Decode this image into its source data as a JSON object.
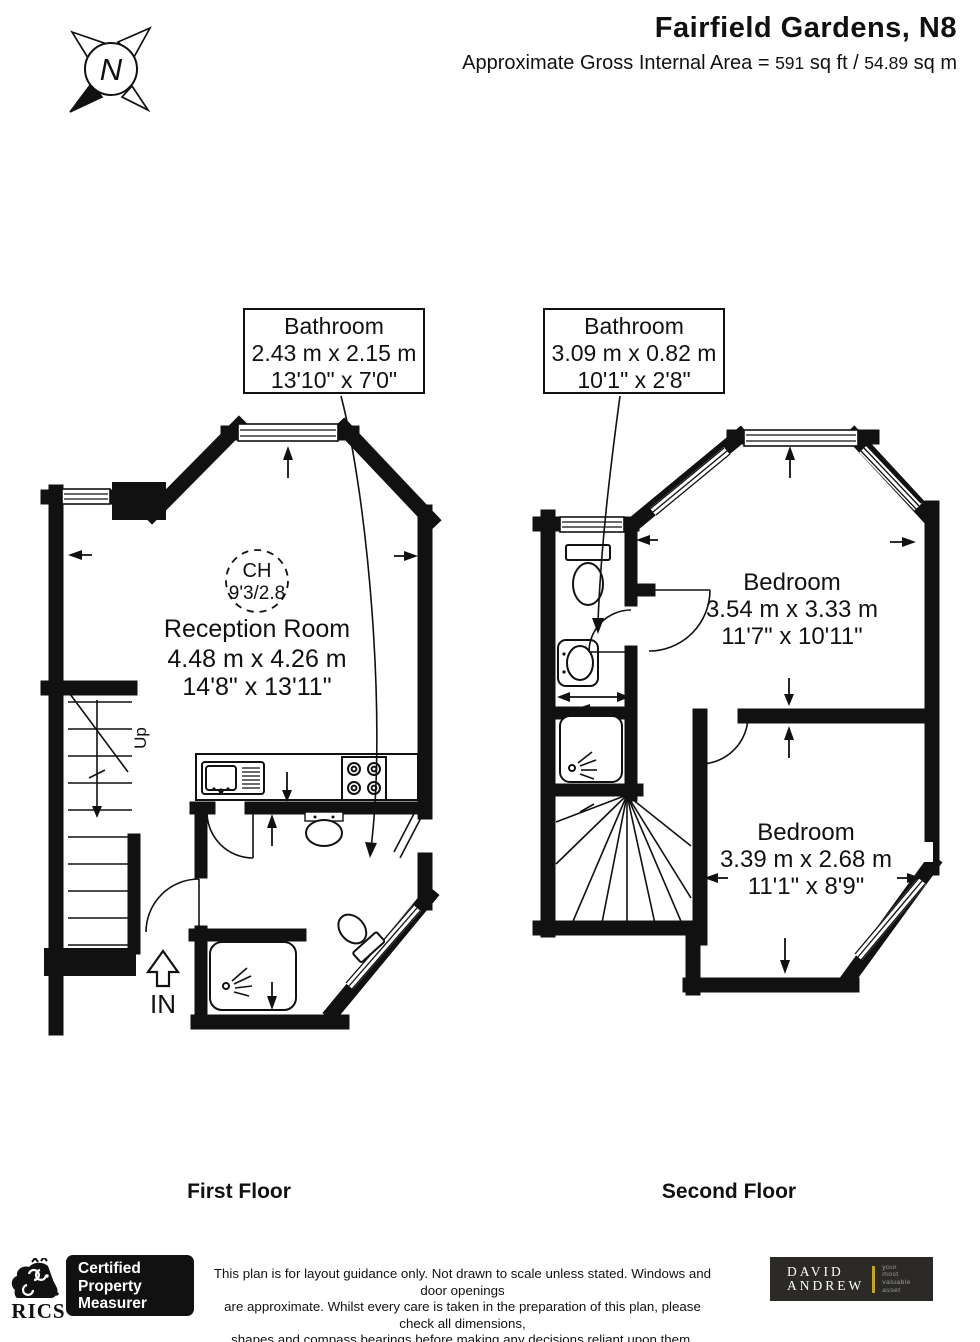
{
  "header": {
    "title": "Fairfield Gardens, N8",
    "area_label": "Approximate Gross Internal Area =",
    "area_sqft": "591",
    "area_sqft_unit": "sq ft /",
    "area_sqm": "54.89",
    "area_sqm_unit": "sq m"
  },
  "compass": {
    "letter": "N"
  },
  "callouts": {
    "ff_bathroom": {
      "name": "Bathroom",
      "metric": "2.43 m x 2.15 m",
      "imperial": "13'10\" x 7'0\""
    },
    "sf_bathroom": {
      "name": "Bathroom",
      "metric": "3.09 m x 0.82 m",
      "imperial": "10'1\" x 2'8\""
    }
  },
  "rooms": {
    "reception": {
      "name": "Reception Room",
      "metric": "4.48 m x 4.26 m",
      "imperial": "14'8\" x 13'11\""
    },
    "bedroom1": {
      "name": "Bedroom",
      "metric": "3.54 m x 3.33 m",
      "imperial": "11'7\" x 10'11\""
    },
    "bedroom2": {
      "name": "Bedroom",
      "metric": "3.39 m x 2.68 m",
      "imperial": "11'1\" x 8'9\""
    }
  },
  "annotations": {
    "ceiling_height": {
      "line1": "CH",
      "line2": "9'3/2.8"
    },
    "up": "Up",
    "entrance": "IN"
  },
  "floor_titles": {
    "first": "First Floor",
    "second": "Second Floor"
  },
  "footer": {
    "rics_name": "RICS",
    "rics_reg": "®",
    "certified_lines": [
      "Certified",
      "Property",
      "Measurer"
    ],
    "disclaimer_lines": [
      "This plan is for layout guidance only. Not drawn to scale unless stated. Windows and door openings",
      "are approximate. Whilst every care is taken in the preparation of this plan, please check all dimensions,",
      "shapes and compass bearings before making any decisions reliant upon them."
    ],
    "agency": {
      "word1": "DAVID",
      "word2": "ANDREW",
      "tagline_lines": [
        "your",
        "most",
        "valuable",
        "asset"
      ]
    }
  },
  "colors": {
    "ink": "#111111",
    "agency_bg": "#2b2a27",
    "agency_gold": "#c2a32e",
    "agency_gray": "#9a9a9a"
  }
}
